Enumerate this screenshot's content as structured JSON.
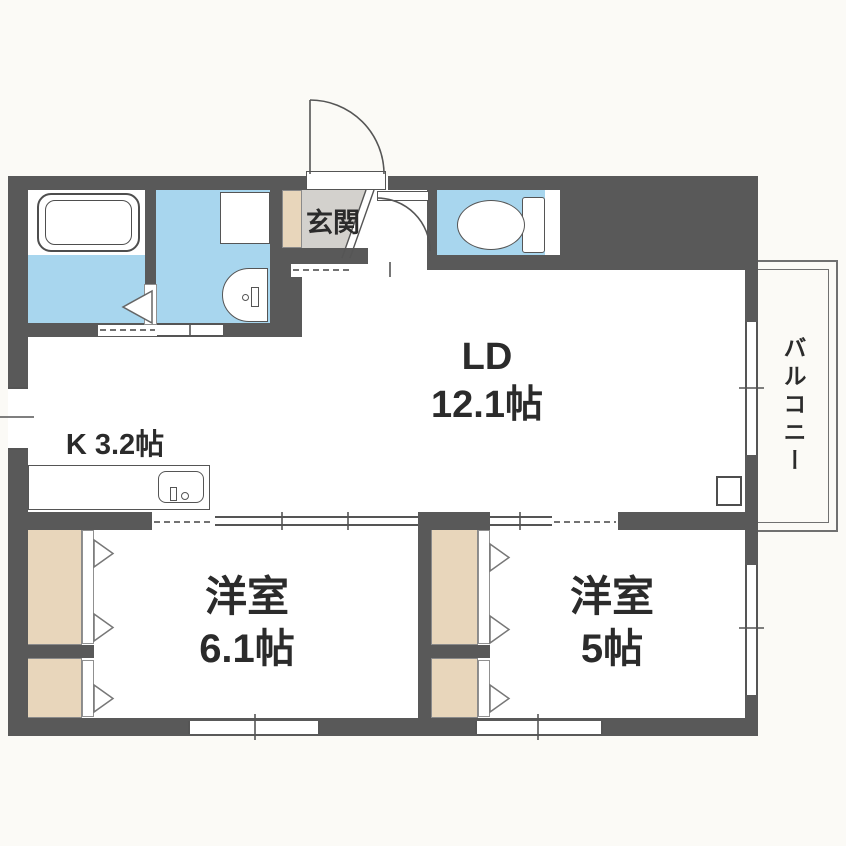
{
  "plan": {
    "rooms": {
      "living_dining": {
        "name": "LD",
        "size": "12.1帖"
      },
      "kitchen": {
        "label": "K 3.2帖"
      },
      "bedroom_left": {
        "name": "洋室",
        "size": "6.1帖"
      },
      "bedroom_right": {
        "name": "洋室",
        "size": "5帖"
      },
      "entrance": {
        "label": "玄関"
      },
      "balcony": {
        "label": "バルコニー"
      }
    },
    "fixtures": [
      "bathtub",
      "washing-machine-space",
      "washbasin",
      "toilet",
      "kitchen-counter",
      "kitchen-sink",
      "shoe-cabinet",
      "closet",
      "entrance-door",
      "interior-door",
      "folding-bath-door",
      "sliding-doors",
      "windows",
      "pipe-space-box"
    ],
    "colors": {
      "wall": "#595959",
      "wet_area": "#a8d6ee",
      "closet": "#e8d6bb",
      "entrance_floor": "#d3d1cd",
      "room": "#ffffff",
      "background": "#fbfaf6"
    }
  }
}
